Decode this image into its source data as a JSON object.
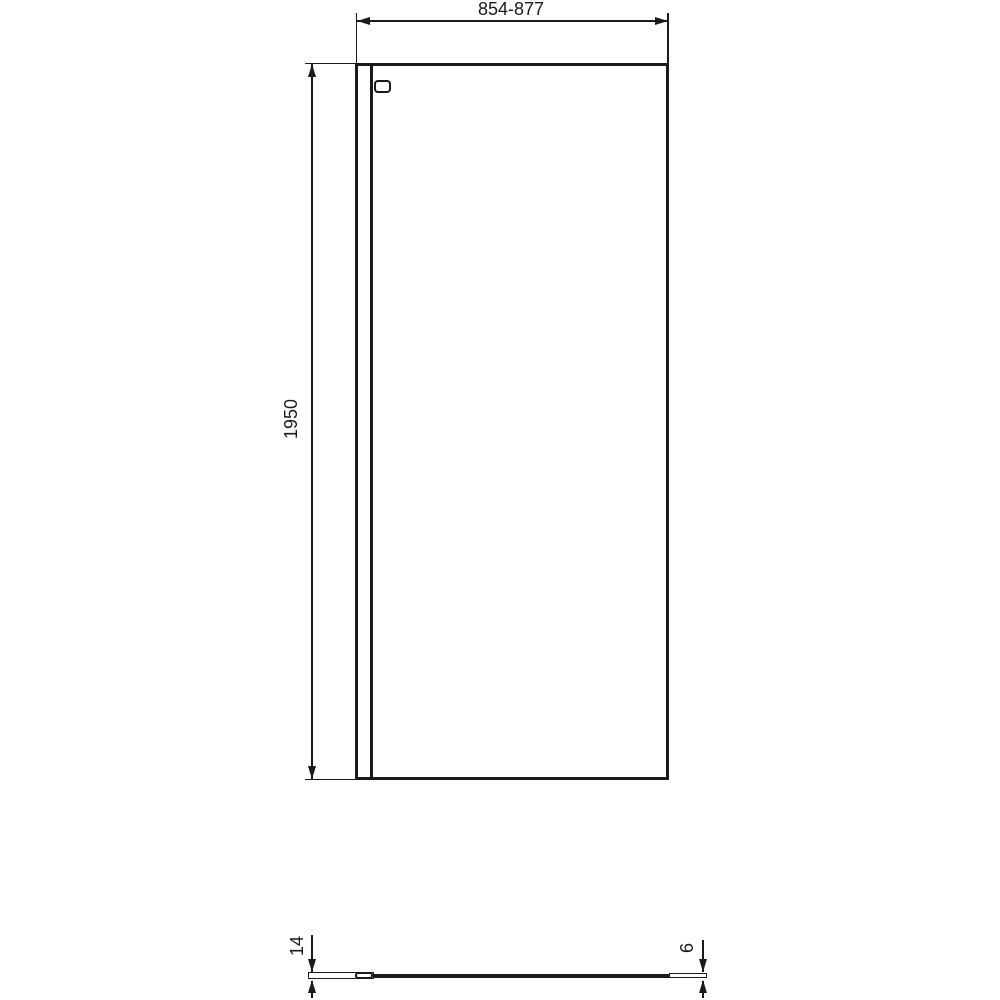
{
  "canvas": {
    "background_color": "#ffffff",
    "line_color": "#1a1a1a"
  },
  "front_view": {
    "width_dimension": {
      "label": "854-877"
    },
    "height_dimension": {
      "label": "1950"
    }
  },
  "plan_view": {
    "profile_depth_dimension": {
      "label": "14"
    },
    "glass_thickness_dimension": {
      "label": "6"
    }
  }
}
